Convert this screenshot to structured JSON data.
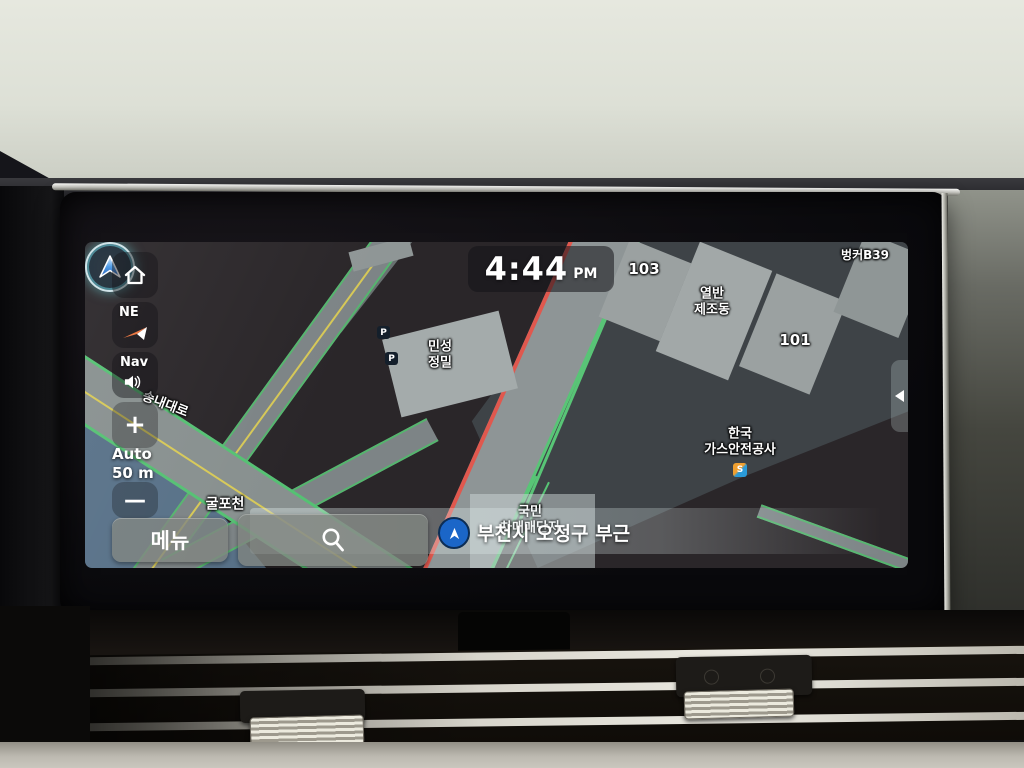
{
  "screen": {
    "clock": {
      "time": "4:44",
      "meridiem": "PM"
    },
    "bunker_label": "벙커B39",
    "sidebar": {
      "compass": "NE",
      "nav": "Nav",
      "zoom_in": "+",
      "zoom_out": "—",
      "scale_line1": "Auto",
      "scale_line2": "50 m"
    },
    "bottom": {
      "menu": "메뉴",
      "location": "부천시 오정구 부근"
    },
    "map_labels": {
      "bldg103": "103",
      "bldg101": "101",
      "factory_line1": "열반",
      "factory_line2": "제조동",
      "minseong_line1": "민성",
      "minseong_line2": "정밀",
      "gas_line1": "한국",
      "gas_line2": "가스안전공사",
      "kgs_logo": "S",
      "car_market_line1": "국민",
      "car_market_line2": "차매매단지",
      "river": "굴포천",
      "road": "송내대로",
      "parking": "P"
    },
    "colors": {
      "traffic_red": "#e0584e",
      "traffic_green": "#58c576",
      "lane_yellow": "#e0cf52",
      "marker_blue": "#1b66c8"
    }
  }
}
